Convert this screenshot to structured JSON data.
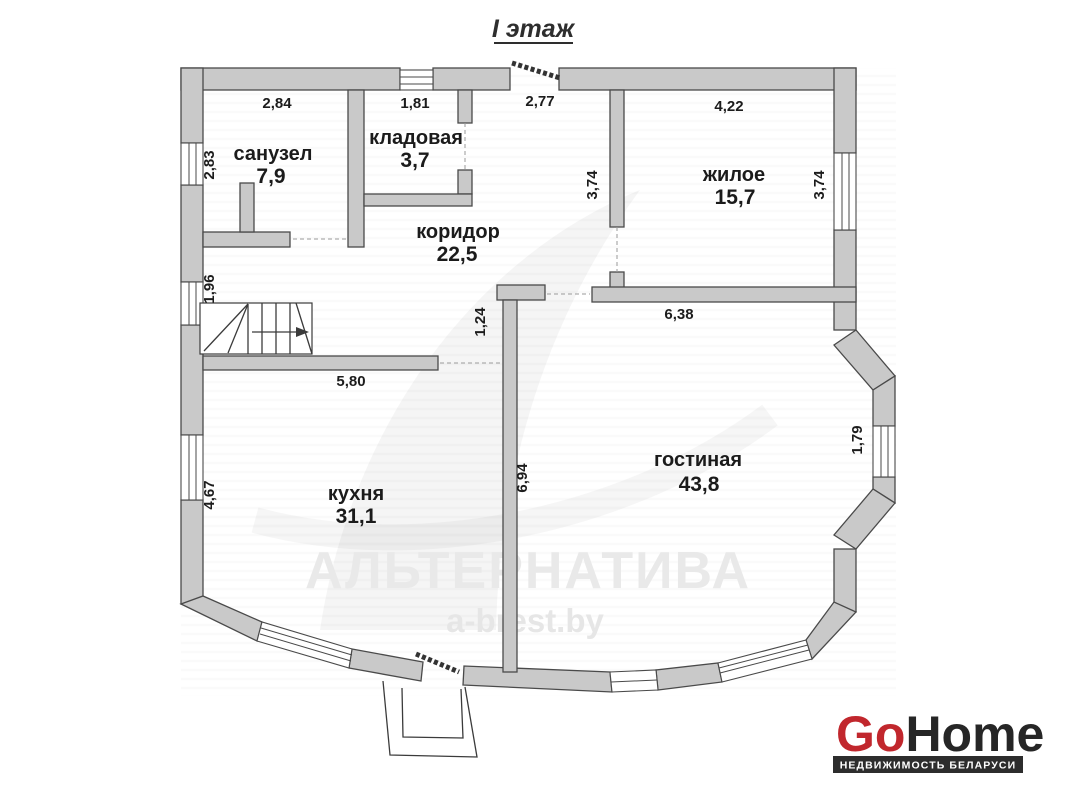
{
  "title": "I этаж",
  "plan": {
    "rooms": {
      "sanuzel": {
        "name": "санузел",
        "area": "7,9"
      },
      "kladovaya": {
        "name": "кладовая",
        "area": "3,7"
      },
      "koridor": {
        "name": "коридор",
        "area": "22,5"
      },
      "zhiloe": {
        "name": "жилое",
        "area": "15,7"
      },
      "kuhnya": {
        "name": "кухня",
        "area": "31,1"
      },
      "gostinaya": {
        "name": "гостиная",
        "area": "43,8"
      }
    },
    "dims": {
      "sanuzel_w": "2,84",
      "kladovaya_w": "1,81",
      "entrance_w": "2,77",
      "zhiloe_w": "4,22",
      "sanuzel_h": "2,83",
      "zhiloe_h_left": "3,74",
      "zhiloe_h_right": "3,74",
      "stairs_h": "1,96",
      "gostinaya_w": "6,38",
      "passage_w": "1,24",
      "koridor_w": "5,80",
      "kuhnya_h": "4,67",
      "kuhnya_wall_h": "6,94",
      "bay_window_h": "1,79"
    }
  },
  "watermark": {
    "brand": "АЛЬТЕРНАТИВА",
    "site": "a-brest.by"
  },
  "logo": {
    "go": "Go",
    "home": "Home",
    "tagline": "НЕДВИЖИМОСТЬ БЕЛАРУСИ"
  },
  "colors": {
    "wall_fill": "#c9c9c9",
    "wall_stroke": "#4a4a4a",
    "logo_red": "#c1272d",
    "logo_dark": "#262626",
    "tag_bar": "#2d2d2d",
    "watermark": "#e9e9e9"
  }
}
